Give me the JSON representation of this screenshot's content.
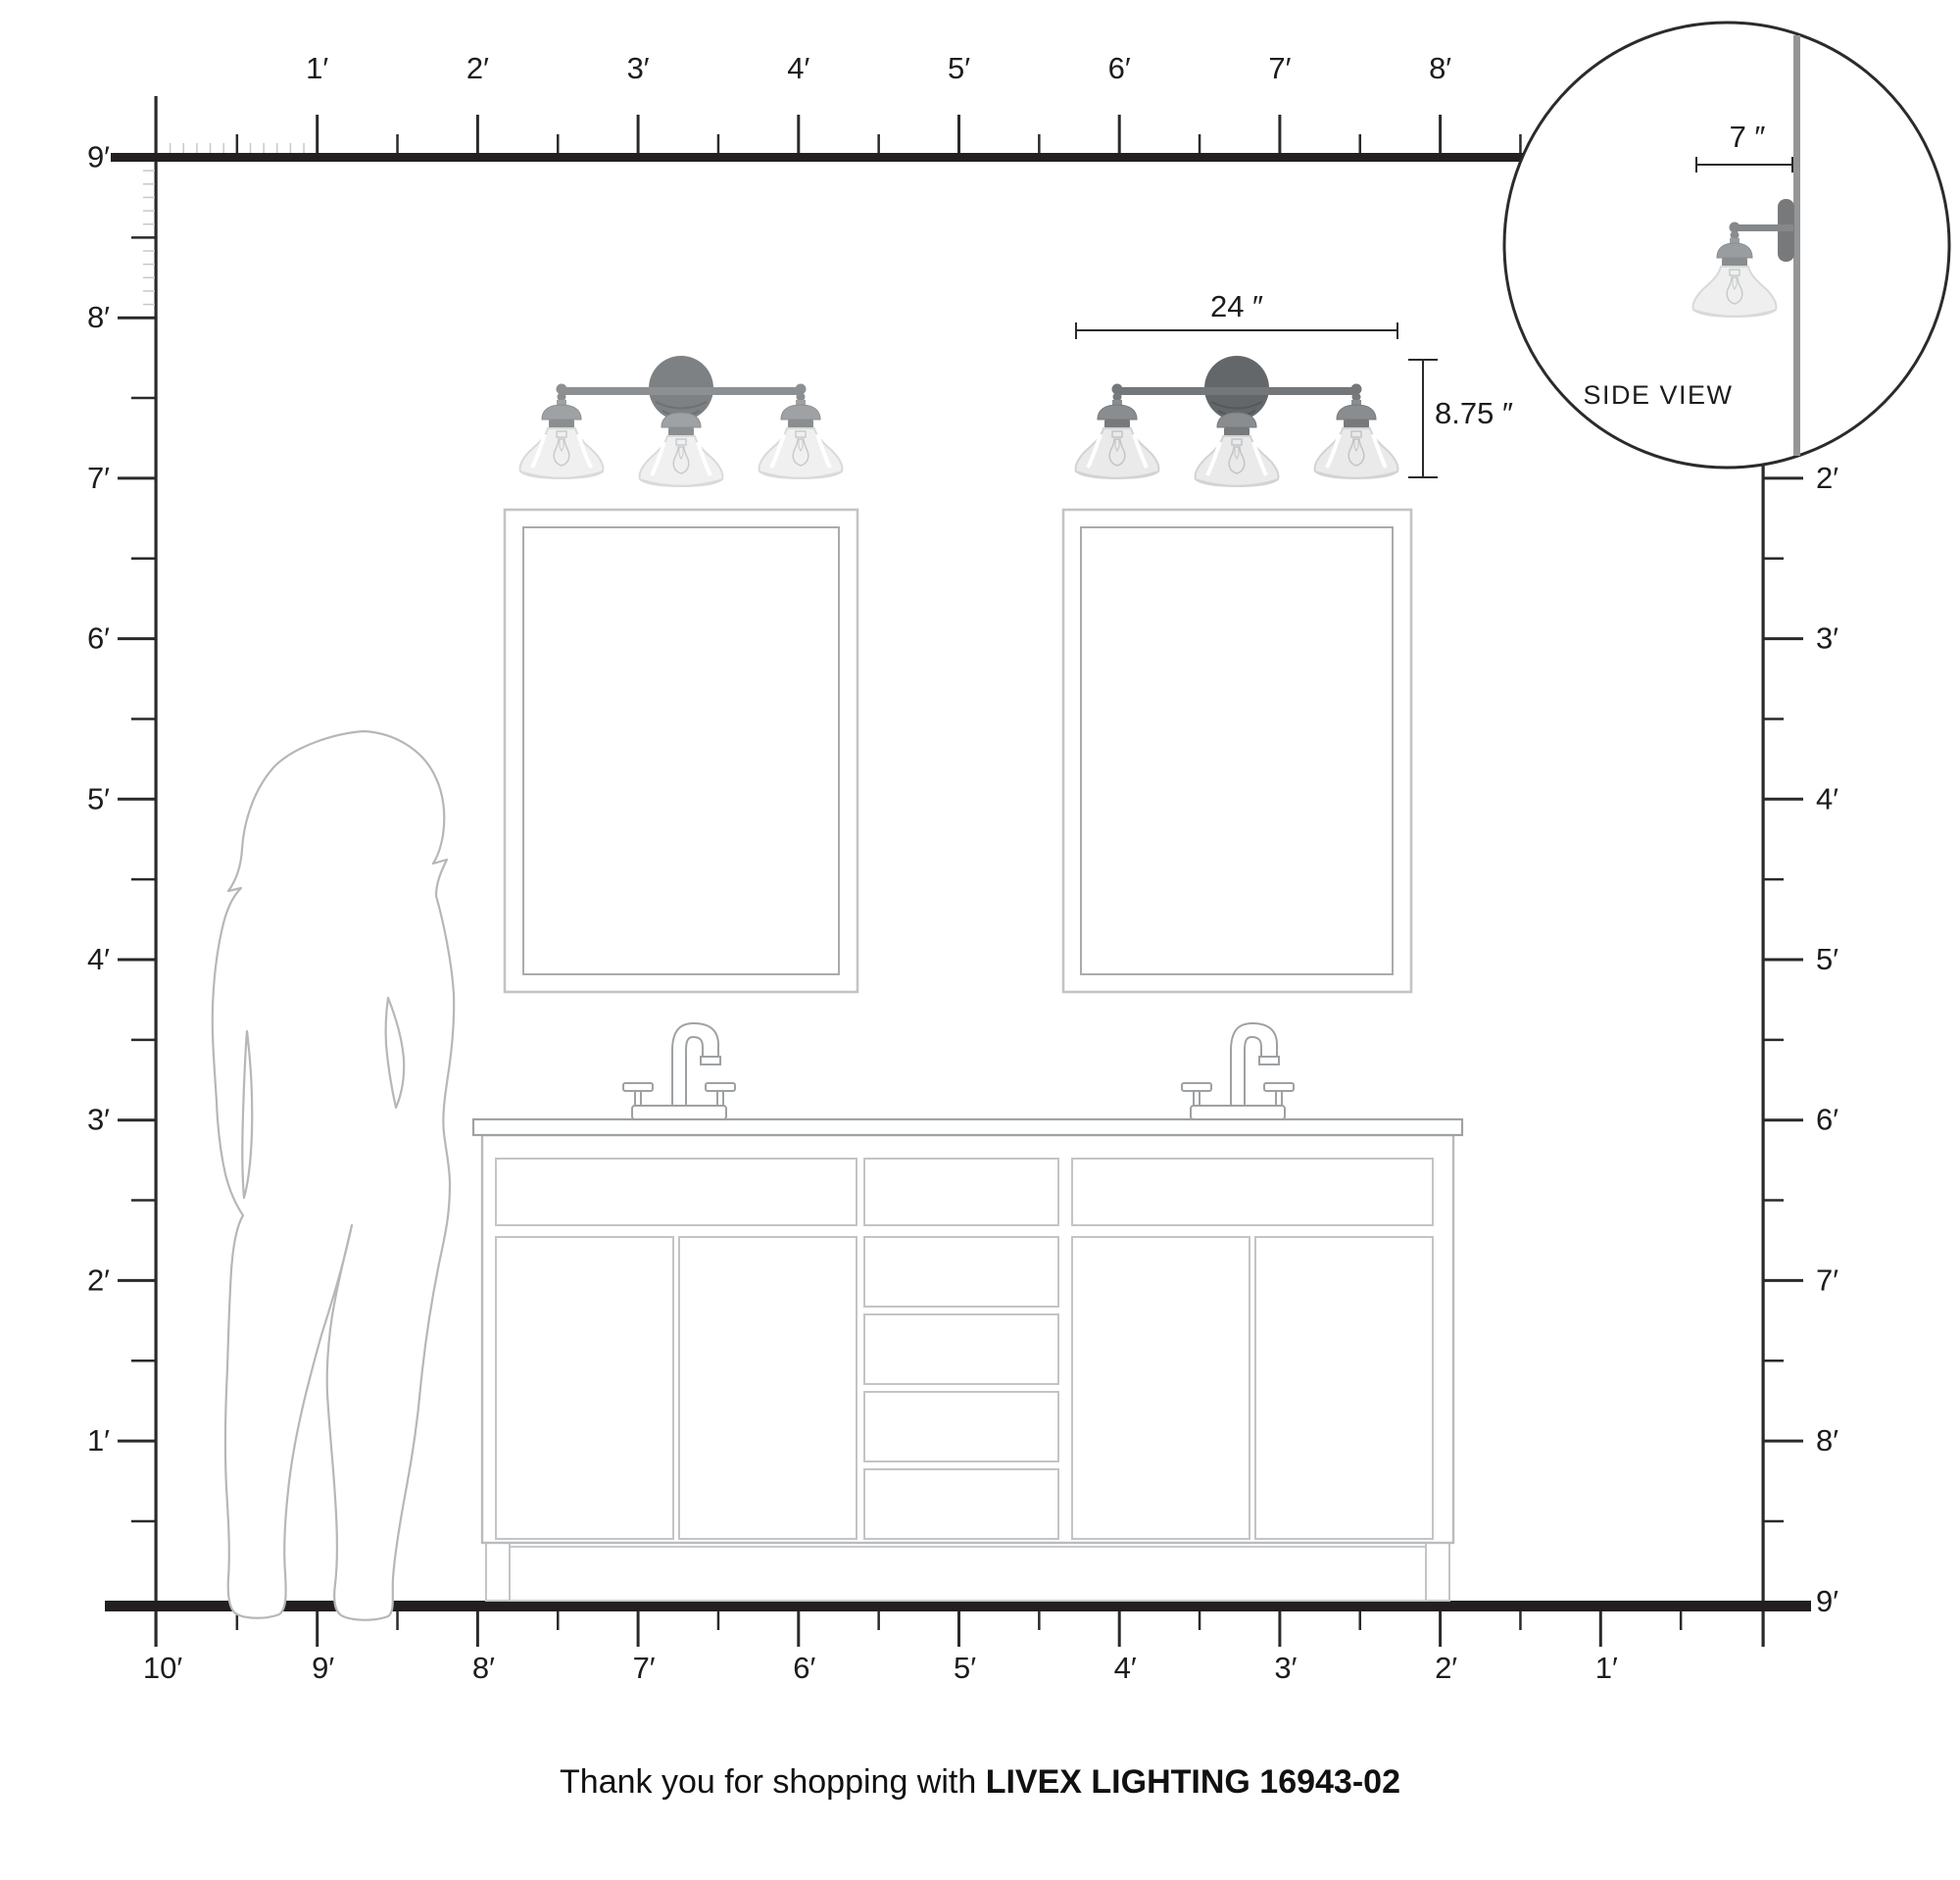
{
  "title": "Livex Lighting vanity light size diagram",
  "rulers": {
    "unit": "feet",
    "top": [
      "1′",
      "2′",
      "3′",
      "4′",
      "5′",
      "6′",
      "7′",
      "8′"
    ],
    "left": [
      "9′",
      "8′",
      "7′",
      "6′",
      "5′",
      "4′",
      "3′",
      "2′",
      "1′"
    ],
    "right": [
      "2′",
      "3′",
      "4′",
      "5′",
      "6′",
      "7′",
      "8′",
      "9′"
    ],
    "bottom": [
      "10′",
      "9′",
      "8′",
      "7′",
      "6′",
      "5′",
      "4′",
      "3′",
      "2′",
      "1′"
    ]
  },
  "dimensions": {
    "fixture_width": "24 ″",
    "fixture_height": "8.75 ″",
    "fixture_extension": "7 ″"
  },
  "side_view": {
    "label": "SIDE VIEW"
  },
  "fixtures": {
    "description": "3-light bell-shade vanity fixture over mirror",
    "lights_per_fixture": 3,
    "fixture_count": 2
  },
  "footer": {
    "regular": "Thank you for shopping with",
    "bold": "LIVEX LIGHTING 16943-02"
  },
  "colors": {
    "ink": "#231f20",
    "tick": "#2a2a2b",
    "inch_tick": "#c6c8ca",
    "line_light": "#c2c4c6",
    "line_mid": "#a9abae",
    "silhouette": "#b5b7b9",
    "left_fixture_canopy": "#7e8183",
    "right_fixture_canopy": "#646769",
    "shade": "#efefef",
    "side_wall": "#939597"
  }
}
